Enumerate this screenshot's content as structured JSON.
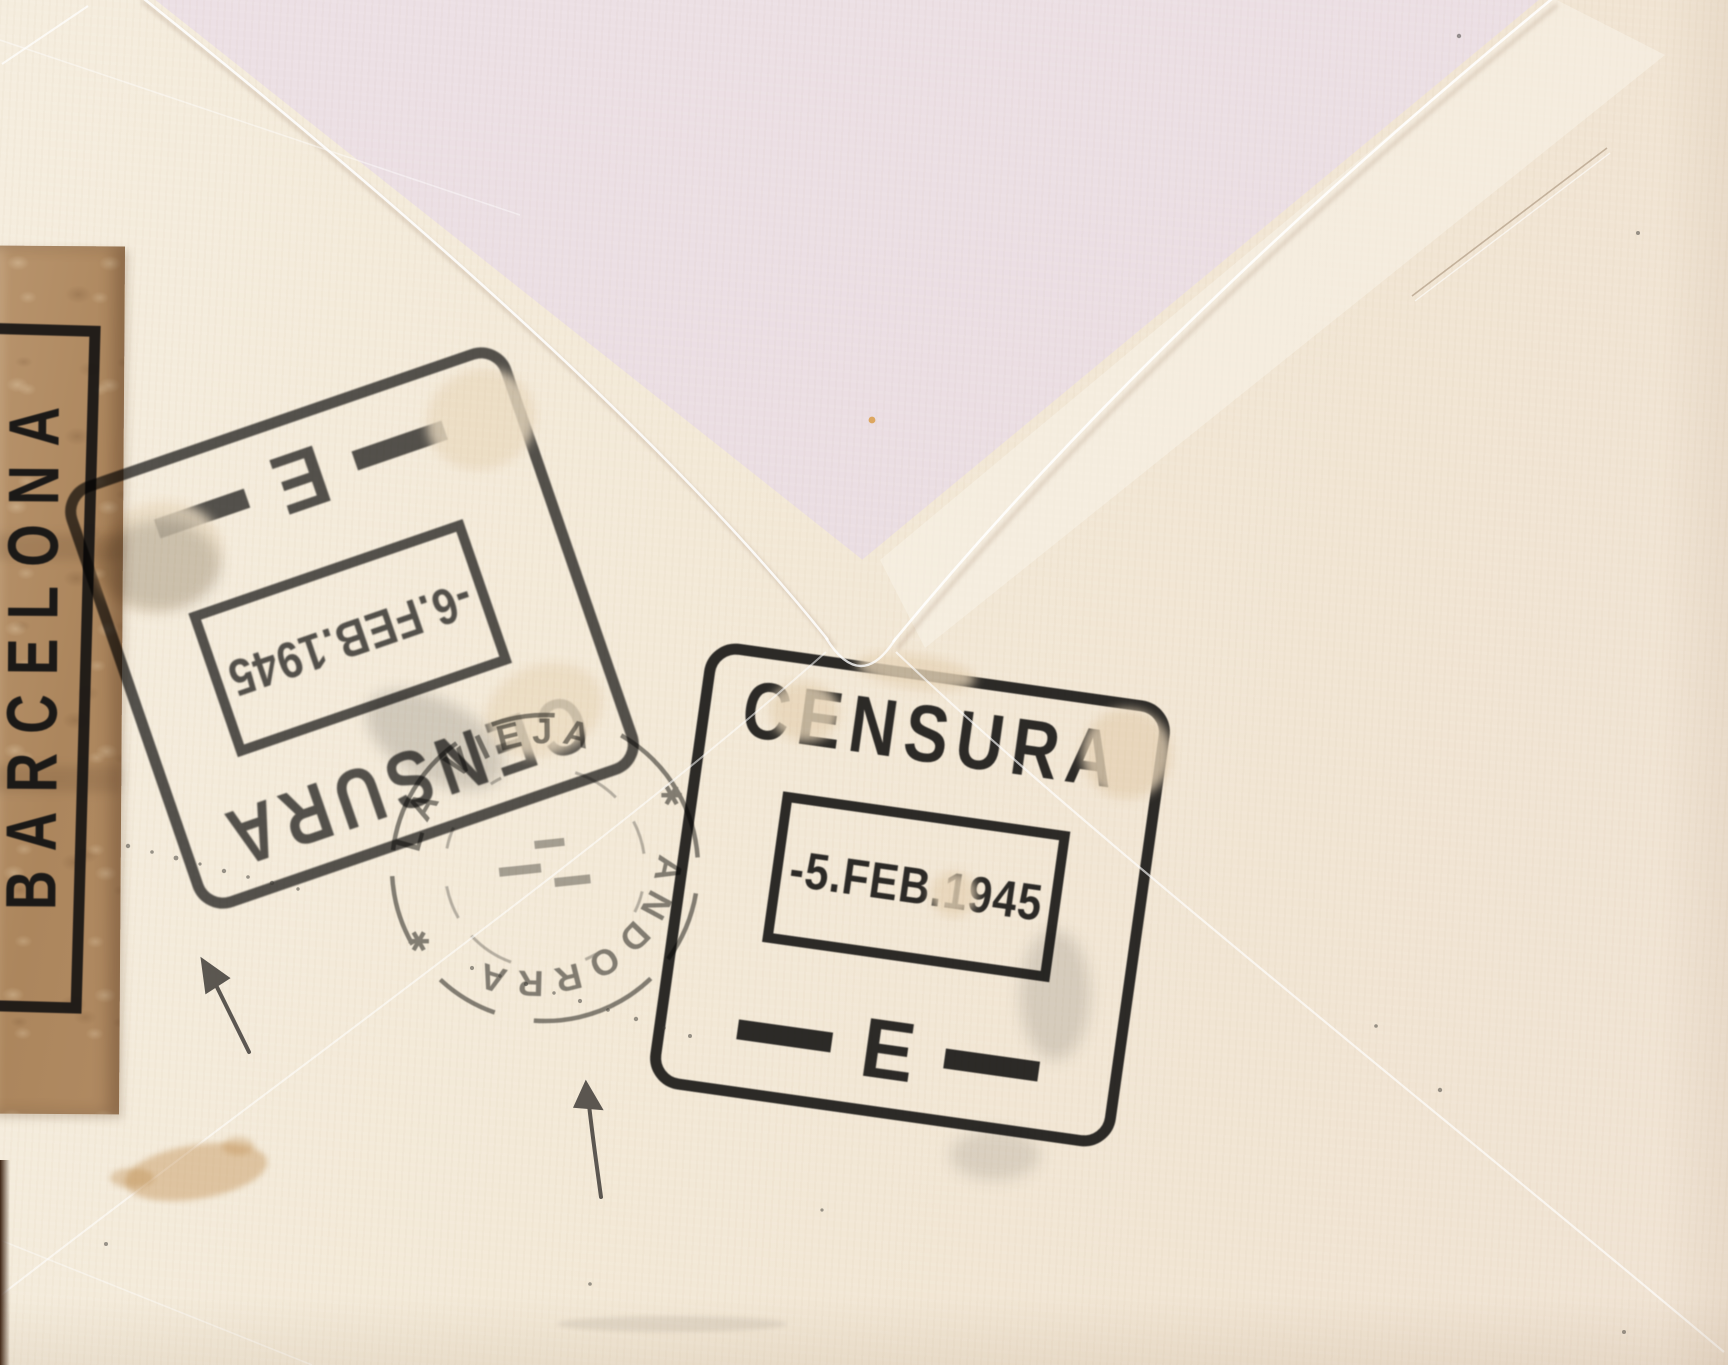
{
  "censor_tape": {
    "city_label": "BARCELONA"
  },
  "censor_stamp_upright": {
    "word": "CENSURA",
    "date": "-5.FEB.1945",
    "letter_mark": "E"
  },
  "censor_stamp_inverted": {
    "word": "CENSURA",
    "date": "-6.FEB.1945",
    "letter_mark": "E"
  },
  "postmark": {
    "arc_top": "ANDORRA",
    "arc_bottom": "LA VIEJA",
    "separator": "✱"
  },
  "colors": {
    "paper_cream": "#f2e8d7",
    "flap_tint_pink": "#eadde2",
    "tape_brown": "#b1895f",
    "stamp_ink": "#1c1c1c",
    "pen_ink": "#4b4742",
    "stain_tan": "#c99a5e"
  }
}
